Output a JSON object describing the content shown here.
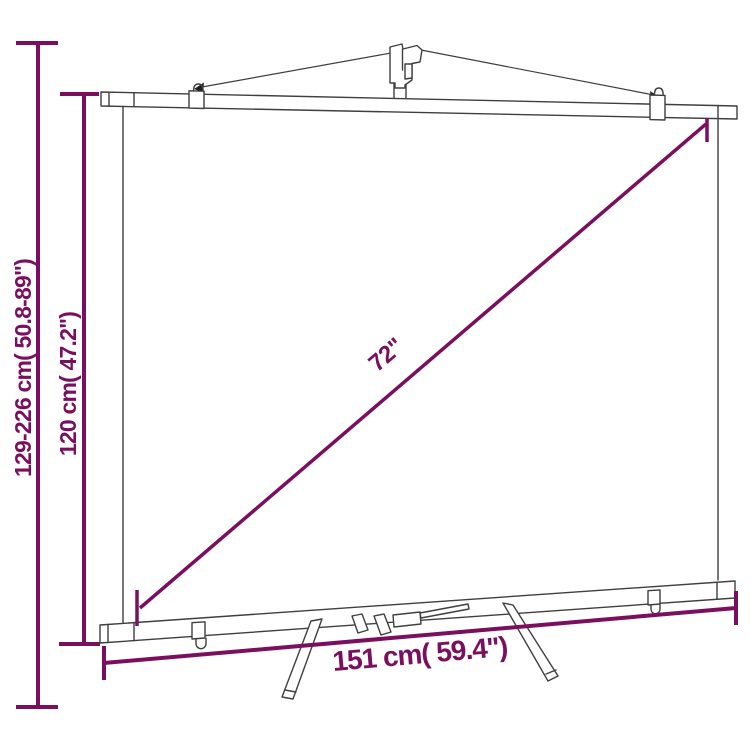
{
  "diagram": {
    "title": "Tripod projection screen dimension diagram",
    "accent_color": "#7b0f5f",
    "outline_color": "#3f3f3f",
    "background_color": "#ffffff",
    "dimensions": {
      "stand_height": {
        "label": "129-226 cm( 50.8-89\")",
        "orientation": "vertical",
        "measures": "overall adjustable stand height"
      },
      "screen_height": {
        "label": "120 cm( 47.2\")",
        "orientation": "vertical",
        "measures": "screen height"
      },
      "diagonal": {
        "label": "72\"",
        "orientation": "diagonal",
        "measures": "screen diagonal"
      },
      "screen_width": {
        "label": "151 cm( 59.4\")",
        "orientation": "horizontal",
        "measures": "screen width"
      }
    }
  }
}
